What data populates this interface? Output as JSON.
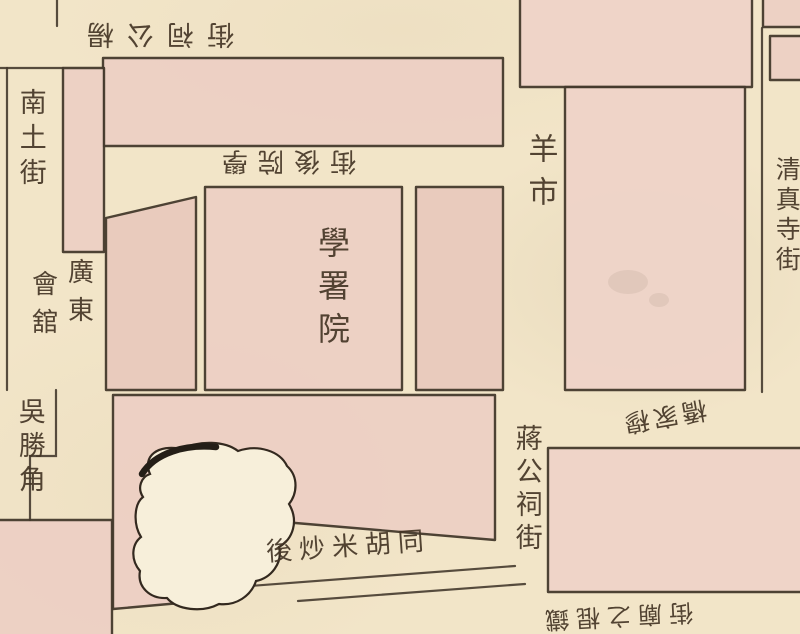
{
  "map": {
    "type": "historical-chinese-city-map",
    "colors": {
      "paper": "#f2e5c8",
      "block_pink": "#edd0c4",
      "block_pink_deep": "#e9cabd",
      "ink": "#453a2d",
      "pond": "#f7efda"
    },
    "labels": {
      "top_street": "楊公祠街",
      "nantu_street": "南土街",
      "xueyuan_back_street": "學院後街",
      "xueshu_yuan_compound": "學署院",
      "guild_hall_col_right": "廣東",
      "guild_hall_col_left": "會舘",
      "yang_shi": "羊市",
      "qingzhensi_street": "清真寺街",
      "mu_jia_qiao": "穆家橋",
      "jiang_gong_ci_street": "蔣公祠街",
      "wu_sheng_jiao": "吳勝角",
      "hou_chaomi_hutong": "後炒米胡同",
      "bottom_right_street": "鐵棍之廟街"
    }
  }
}
